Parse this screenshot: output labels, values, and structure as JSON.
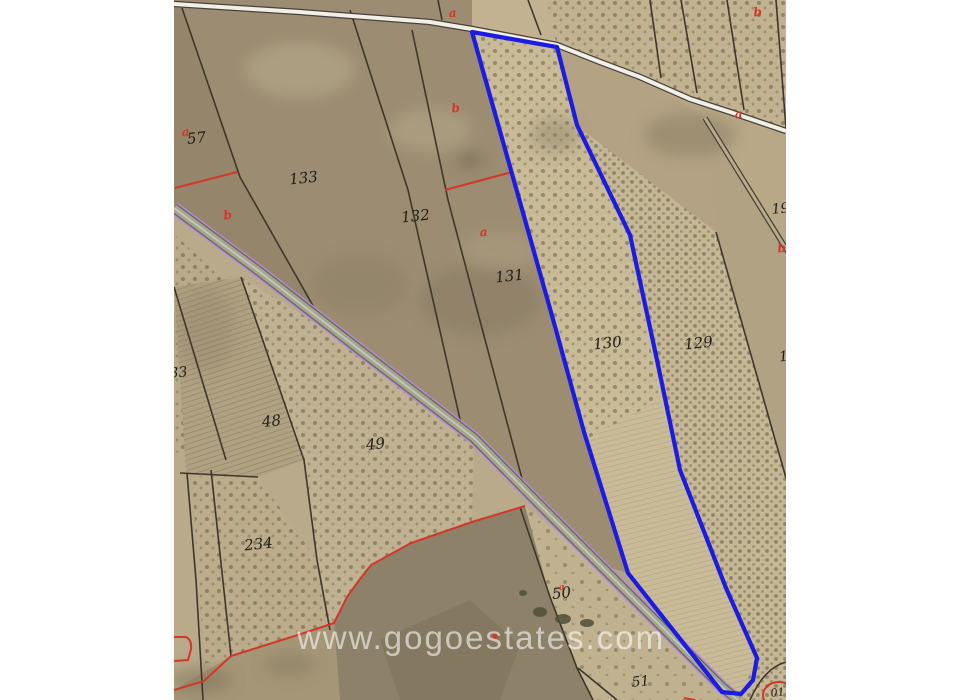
{
  "watermark": {
    "text": "www.gogoestates.com"
  },
  "map": {
    "type": "cadastral-aerial-view",
    "highlighted_parcel": "130",
    "parcels": [
      {
        "label": "57",
        "x": 197,
        "y": 143,
        "size": 15
      },
      {
        "label": "133",
        "x": 304,
        "y": 183,
        "size": 15
      },
      {
        "label": "132",
        "x": 416,
        "y": 221,
        "size": 15
      },
      {
        "label": "131",
        "x": 510,
        "y": 281,
        "size": 15
      },
      {
        "label": "130",
        "x": 608,
        "y": 348,
        "size": 15
      },
      {
        "label": "129",
        "x": 699,
        "y": 348,
        "size": 15
      },
      {
        "label": "19",
        "x": 781,
        "y": 213,
        "size": 14
      },
      {
        "label": "1",
        "x": 784,
        "y": 361,
        "size": 14
      },
      {
        "label": "33",
        "x": 179,
        "y": 377,
        "size": 14
      },
      {
        "label": "48",
        "x": 272,
        "y": 426,
        "size": 15
      },
      {
        "label": "49",
        "x": 376,
        "y": 449,
        "size": 15
      },
      {
        "label": "234",
        "x": 259,
        "y": 549,
        "size": 15
      },
      {
        "label": "50",
        "x": 562,
        "y": 598,
        "size": 15
      },
      {
        "label": "51",
        "x": 641,
        "y": 686,
        "size": 14
      },
      {
        "label": "01",
        "x": 778,
        "y": 696,
        "size": 11
      }
    ],
    "subparcel_markers": [
      {
        "label": "a",
        "x": 453,
        "y": 17,
        "size": 12
      },
      {
        "label": "b",
        "x": 758,
        "y": 16,
        "size": 12
      },
      {
        "label": "a",
        "x": 186,
        "y": 136,
        "size": 12
      },
      {
        "label": "b",
        "x": 456,
        "y": 112,
        "size": 12
      },
      {
        "label": "a",
        "x": 739,
        "y": 118,
        "size": 12
      },
      {
        "label": "b",
        "x": 228,
        "y": 219,
        "size": 12
      },
      {
        "label": "a",
        "x": 484,
        "y": 236,
        "size": 12
      },
      {
        "label": "b",
        "x": 782,
        "y": 252,
        "size": 12
      },
      {
        "label": "a",
        "x": 562,
        "y": 590,
        "size": 9
      }
    ]
  },
  "colors": {
    "highlight_blue": "#1b1be4",
    "cadastral_red": "#d2372a",
    "boundary_black": "#3f362b",
    "road_edge_purple": "#b48be0",
    "terrain_tan": "#b9aa8b"
  }
}
